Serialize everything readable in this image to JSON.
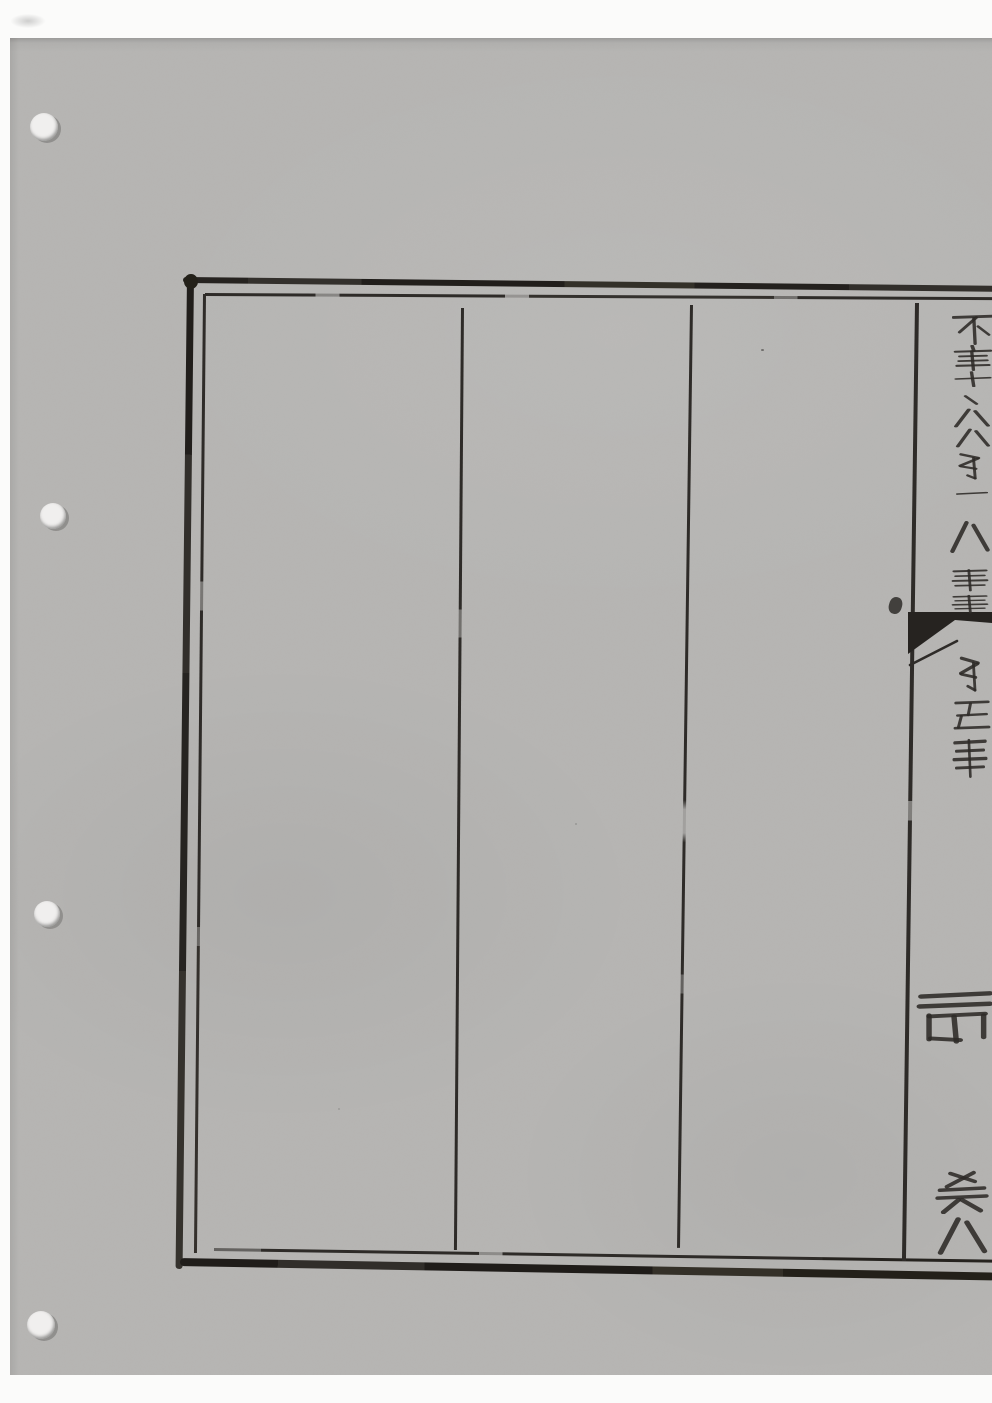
{
  "artifact": {
    "kind": "scanned page of a woodblock-printed Chinese book",
    "page_content": "blank ruled text columns; only the centerfold (banxin) column at the right edge carries half-cut characters and a black fishtail mark",
    "readable_text": ""
  },
  "colors": {
    "scanner_background": "#fbfbfa",
    "paper": "#b6b5b3",
    "ink": "#2e2b28",
    "hole_fill": "#f0efee",
    "hole_shadow": "#908f8d"
  },
  "punch_holes": [
    {
      "cx": 44,
      "cy": 127,
      "r": 14
    },
    {
      "cx": 53,
      "cy": 516,
      "r": 13
    },
    {
      "cx": 47,
      "cy": 914,
      "r": 13
    },
    {
      "cx": 41,
      "cy": 1325,
      "r": 14
    }
  ],
  "printed_frame": {
    "border": "double rule (thick outer, thin inner), right side cut off at scan edge",
    "visible_columns": 3,
    "fishtail_mark": "single black fishtail at head of centerfold column"
  },
  "glyph_fragments": [
    {
      "region": "title-column",
      "glyph_guess": "不",
      "pattern": "bu",
      "x": 952,
      "y": 313,
      "w": 42,
      "h": 32
    },
    {
      "region": "title-column",
      "glyph_guess": "乾",
      "pattern": "dense",
      "x": 952,
      "y": 345,
      "w": 42,
      "h": 26
    },
    {
      "region": "title-column",
      "glyph_guess": "十",
      "pattern": "shi",
      "x": 954,
      "y": 371,
      "w": 38,
      "h": 16
    },
    {
      "region": "title-column",
      "glyph_guess": "、",
      "pattern": "tick",
      "x": 960,
      "y": 394,
      "w": 22,
      "h": 12
    },
    {
      "region": "title-column",
      "glyph_guess": "人",
      "pattern": "ba",
      "x": 952,
      "y": 408,
      "w": 40,
      "h": 20
    },
    {
      "region": "title-column",
      "glyph_guess": "人",
      "pattern": "ba",
      "x": 954,
      "y": 428,
      "w": 38,
      "h": 20
    },
    {
      "region": "title-column",
      "glyph_guess": "第",
      "pattern": "hook",
      "x": 950,
      "y": 452,
      "w": 42,
      "h": 30
    },
    {
      "region": "title-column",
      "glyph_guess": "一",
      "pattern": "heng",
      "x": 956,
      "y": 488,
      "w": 32,
      "h": 11
    },
    {
      "region": "title-column",
      "glyph_guess": "八",
      "pattern": "ba",
      "x": 948,
      "y": 520,
      "w": 44,
      "h": 34
    },
    {
      "region": "title-column",
      "glyph_guess": "言",
      "pattern": "rows",
      "x": 950,
      "y": 568,
      "w": 40,
      "h": 24
    },
    {
      "region": "title-column",
      "glyph_guess": "誌",
      "pattern": "rows",
      "x": 950,
      "y": 594,
      "w": 40,
      "h": 20
    },
    {
      "region": "below-fishtail",
      "glyph_guess": "第",
      "pattern": "hook",
      "x": 951,
      "y": 655,
      "w": 40,
      "h": 40
    },
    {
      "region": "below-fishtail",
      "glyph_guess": "五",
      "pattern": "wu",
      "x": 953,
      "y": 700,
      "w": 38,
      "h": 30
    },
    {
      "region": "below-fishtail",
      "glyph_guess": "誌",
      "pattern": "rows",
      "x": 951,
      "y": 737,
      "w": 38,
      "h": 42
    },
    {
      "region": "page-number",
      "glyph_guess": "禹",
      "pattern": "yu",
      "x": 915,
      "y": 990,
      "w": 78,
      "h": 55
    },
    {
      "region": "lower-fold",
      "glyph_guess": "卷",
      "pattern": "juan",
      "x": 933,
      "y": 1170,
      "w": 58,
      "h": 44
    },
    {
      "region": "lower-fold",
      "glyph_guess": "八",
      "pattern": "ba",
      "x": 935,
      "y": 1216,
      "w": 55,
      "h": 40
    }
  ]
}
